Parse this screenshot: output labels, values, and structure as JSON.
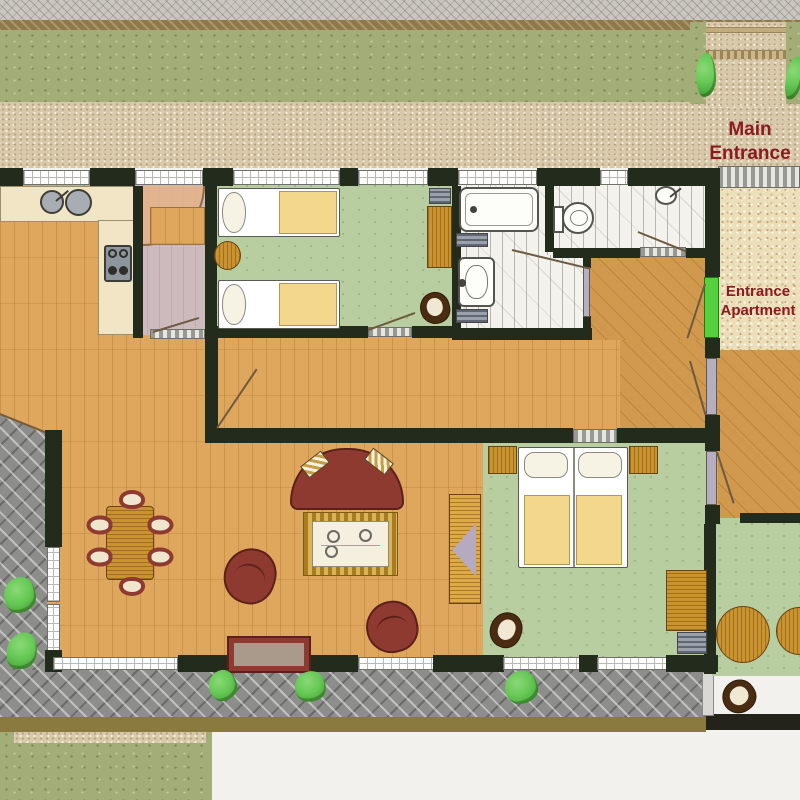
{
  "labels": {
    "main_entrance": {
      "line1": "Main",
      "line2": "Entrance"
    },
    "apartment_entrance": {
      "line1": "Entrance",
      "line2": "Apartment"
    }
  },
  "colors": {
    "wall": "#232b1d",
    "wood": "#dfa75d",
    "wood_right": "#d0994e",
    "green_floor": "#b8cda0",
    "tile": "#f3f2ec",
    "mauve": "#cdbabd",
    "counter": "#f1e5c6",
    "terrace": "#8d8d8b",
    "grass": "#a3ad77",
    "path": "#d9c9ab",
    "gravel": "#cbc7c0",
    "earth": "#8f784a",
    "stipple": "#ebdfb9",
    "olive_strip": "#8a7a3f",
    "accent_text": "#8a1b20",
    "door_green": "#55d03e",
    "door_leaf": "#b6afc2",
    "sofa_red": "#8e3a31",
    "sofa_dark": "#5c201a",
    "gold_wood": "#c9932f",
    "blanket_yellow": "#f2d78c",
    "plant_green": "#66c855",
    "gray_fixture": "#9aa1ad",
    "white_fixture": "#fdfdfa"
  }
}
